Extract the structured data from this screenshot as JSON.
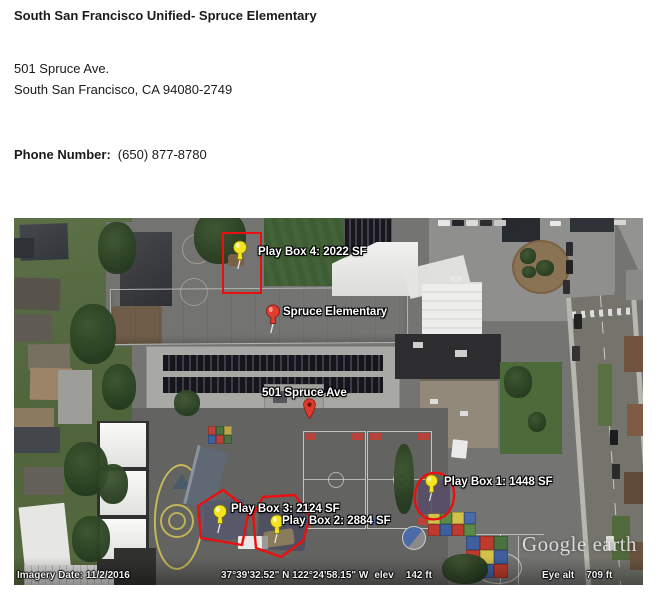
{
  "header": {
    "title": "South San Francisco Unified- Spruce Elementary",
    "address_line1": "501 Spruce Ave.",
    "address_line2": "South San Francisco, CA 94080-2749",
    "phone_label": "Phone Number:",
    "phone_value": "(650) 877-8780"
  },
  "map": {
    "pins": {
      "playbox4": {
        "label": "Play Box 4: 2022 SF"
      },
      "playbox3": {
        "label": "Play Box 3: 2124 SF"
      },
      "playbox2": {
        "label": "Play Box 2: 2884 SF"
      },
      "playbox1": {
        "label": "Play Box 1: 1448 SF"
      },
      "school": {
        "label": "Spruce Elementary"
      },
      "address": {
        "label": "501 Spruce Ave"
      }
    },
    "icons": {
      "yellow_pushpin": "pushpin-icon",
      "red_pushpin": "pushpin-icon",
      "red_map_pin": "map-pin-icon"
    },
    "colors": {
      "annotation_red": "#ea1010",
      "pushpin_yellow": "#f4e41f",
      "map_pin_red": "#dd3a2b"
    },
    "status": {
      "imagery_date": "Imagery Date: 11/2/2016",
      "coordinates": "37°39'32.52\" N 122°24'58.15\" W",
      "elev_label": "elev",
      "elev_value": "142 ft",
      "eye_alt_label": "Eye alt",
      "eye_alt_value": "709 ft"
    },
    "watermark": "Google earth"
  }
}
